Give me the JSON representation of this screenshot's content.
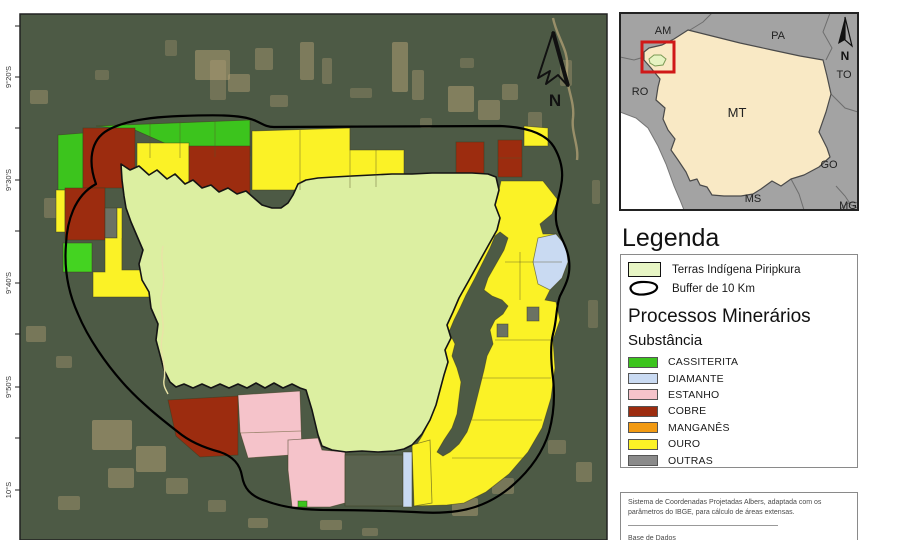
{
  "legend": {
    "title": "Legenda",
    "items": [
      {
        "label": "Terras Indígena Piripkura",
        "swatch_fill": "#e7f5c4"
      },
      {
        "label": "Buffer de 10 Km",
        "swatch": "outline"
      }
    ],
    "section_title": "Processos Minerários",
    "subsection_title": "Substância",
    "substances": [
      {
        "label": "CASSITERITA",
        "color": "#3cc41d"
      },
      {
        "label": "DIAMANTE",
        "color": "#c9daf2"
      },
      {
        "label": "ESTANHO",
        "color": "#f5c3ca"
      },
      {
        "label": "COBRE",
        "color": "#9c2c0f"
      },
      {
        "label": "MANGANÊS",
        "color": "#f29a12"
      },
      {
        "label": "OURO",
        "color": "#fbf226"
      },
      {
        "label": "OUTRAS",
        "color": "#8a8a8a"
      }
    ]
  },
  "notes": {
    "projection": "Sistema de Coordenadas Projetadas Albers, adaptada com os parâmetros do IBGE, para cálculo de áreas extensas.",
    "database_label": "Base de Dados"
  },
  "main_map": {
    "frame": {
      "x": 20,
      "y": 14,
      "w": 587,
      "h": 526
    },
    "bg": "#4d5a45",
    "patch_fill": "#b7a377",
    "patches": [
      [
        195,
        50,
        35,
        30,
        0.5
      ],
      [
        228,
        74,
        22,
        18,
        0.45
      ],
      [
        255,
        48,
        18,
        22,
        0.4
      ],
      [
        300,
        42,
        14,
        38,
        0.45
      ],
      [
        322,
        58,
        10,
        26,
        0.35
      ],
      [
        392,
        42,
        16,
        50,
        0.5
      ],
      [
        412,
        70,
        12,
        30,
        0.4
      ],
      [
        448,
        86,
        26,
        26,
        0.5
      ],
      [
        478,
        100,
        22,
        20,
        0.45
      ],
      [
        502,
        84,
        16,
        16,
        0.4
      ],
      [
        528,
        112,
        14,
        22,
        0.35
      ],
      [
        30,
        90,
        18,
        14,
        0.4
      ],
      [
        44,
        198,
        14,
        20,
        0.35
      ],
      [
        26,
        326,
        20,
        16,
        0.4
      ],
      [
        56,
        356,
        16,
        12,
        0.35
      ],
      [
        92,
        420,
        40,
        30,
        0.55
      ],
      [
        136,
        446,
        30,
        26,
        0.5
      ],
      [
        108,
        468,
        26,
        20,
        0.45
      ],
      [
        166,
        478,
        22,
        16,
        0.4
      ],
      [
        58,
        496,
        22,
        14,
        0.4
      ],
      [
        208,
        500,
        18,
        12,
        0.35
      ],
      [
        248,
        518,
        20,
        10,
        0.4
      ],
      [
        320,
        520,
        22,
        10,
        0.4
      ],
      [
        362,
        528,
        16,
        8,
        0.35
      ],
      [
        452,
        498,
        26,
        18,
        0.45
      ],
      [
        492,
        478,
        22,
        16,
        0.4
      ],
      [
        548,
        440,
        18,
        14,
        0.35
      ],
      [
        576,
        462,
        16,
        20,
        0.4
      ],
      [
        588,
        300,
        10,
        28,
        0.3
      ],
      [
        592,
        180,
        8,
        24,
        0.3
      ],
      [
        262,
        150,
        20,
        12,
        0.3
      ],
      [
        420,
        118,
        12,
        10,
        0.3
      ],
      [
        270,
        95,
        18,
        12,
        0.35
      ],
      [
        350,
        88,
        22,
        10,
        0.3
      ],
      [
        460,
        58,
        14,
        10,
        0.3
      ],
      [
        560,
        60,
        12,
        26,
        0.35
      ],
      [
        240,
        210,
        16,
        9,
        0.3
      ],
      [
        210,
        60,
        16,
        40,
        0.35
      ],
      [
        165,
        40,
        12,
        16,
        0.3
      ],
      [
        95,
        70,
        14,
        10,
        0.3
      ]
    ],
    "rivers_bg": [
      {
        "name": "river-tan",
        "color": "#b3a176",
        "w": 2.4,
        "o": 0.75,
        "d": "M553,18 C557,38 569,50 567,68 C565,86 575,100 573,118 C571,132 579,146 577,160"
      }
    ],
    "features": [
      {
        "name": "claim-cassiterita",
        "fill": "#3cc41d",
        "pts": "96,126 250,120 250,156 198,158 135,130"
      },
      {
        "name": "claim-ouro",
        "fill": "#fbf226",
        "pts": "137,143 189,143 189,198 137,198"
      },
      {
        "name": "claim-cobre",
        "fill": "#9c2c0f",
        "pts": "189,146 250,146 250,198 189,198"
      },
      {
        "name": "claim-cassiterita",
        "fill": "#3cc41d",
        "pts": "58,135 83,133 83,190 58,190"
      },
      {
        "name": "claim-cobre",
        "fill": "#9c2c0f",
        "pts": "83,128 135,128 135,188 83,188"
      },
      {
        "name": "claim-ouro",
        "fill": "#fbf226",
        "pts": "56,190 65,190 65,232 56,232"
      },
      {
        "name": "claim-cobre",
        "fill": "#9c2c0f",
        "pts": "65,188 105,188 105,240 65,240"
      },
      {
        "name": "claim-outras",
        "fill": "#6b7263",
        "pts": "105,208 117,208 117,238 105,238"
      },
      {
        "name": "claim-ouro",
        "fill": "#fbf226",
        "pts": "117,208 122,208 122,270 152,270 152,297 93,297 93,272 105,272 105,238 117,238"
      },
      {
        "name": "claim-cassiterita",
        "fill": "#44d321",
        "pts": "63,243 92,243 92,272 63,272"
      },
      {
        "name": "claim-cassiterita",
        "fill": "#3cc41d",
        "pts": "152,277 190,277 190,307 152,307"
      },
      {
        "name": "claim-ouro",
        "fill": "#fbf226",
        "pts": "252,131 350,128 350,150 404,150 404,187 342,187 342,204 298,204 298,190 252,190"
      },
      {
        "name": "claim-manganes",
        "fill": "#f29a12",
        "pts": "342,187 406,185 406,204 342,204"
      },
      {
        "name": "claim-cobre",
        "fill": "#9c2c0f",
        "pts": "456,142 484,142 484,179 456,179"
      },
      {
        "name": "claim-cobre",
        "fill": "#9c2c0f",
        "pts": "498,140 522,140 522,177 498,177"
      },
      {
        "name": "claim-ouro",
        "fill": "#fbf226",
        "pts": "524,126 548,128 548,146 524,146"
      },
      {
        "name": "claim-ouro",
        "fill": "#fbf226",
        "pts": "501,181 543,181 558,200 552,214 540,224 543,234 556,234 566,246 568,262 562,278 550,290 545,300 556,302 560,320 553,340 555,368 551,398 542,428 528,452 509,474 486,492 464,503 447,505 414,506 412,452 422,436 430,420 436,405 440,390 444,375 448,362 445,350 451,338 447,325 453,312 459,298 468,282 478,264 488,246 497,230 500,218 495,205 499,190"
      },
      {
        "name": "river-corridor",
        "fill": "#4d5a45",
        "pts": "500,232 508,238 504,250 496,264 488,278 484,290 492,296 502,300 508,306 503,314 495,320 490,330 493,344 487,356 484,370 480,386 476,402 472,418 467,432 459,444 450,452 443,456 437,452 444,440 452,428 457,414 459,398 461,382 457,368 452,356 455,344 449,332 454,320 460,308 466,295 474,280 482,264 490,248 495,236"
      },
      {
        "name": "claim-outras",
        "fill": "#6b7263",
        "pts": "527,307 539,307 539,321 527,321"
      },
      {
        "name": "claim-outras",
        "fill": "#6b7263",
        "pts": "497,324 508,324 508,337 497,337"
      },
      {
        "name": "claim-diamante",
        "fill": "#c9daf2",
        "pts": "538,238 556,234 566,246 568,262 562,278 550,290 538,284 533,262"
      },
      {
        "name": "claim-cobre",
        "fill": "#9c2c0f",
        "pts": "168,400 238,396 238,455 200,457 176,436"
      },
      {
        "name": "claim-estanho",
        "fill": "#f5c3ca",
        "pts": "238,395 300,391 302,452 291,455 248,458 240,432"
      },
      {
        "name": "claim-estanho",
        "fill": "#f5c3ca",
        "pts": "288,440 318,438 322,450 345,452 345,503 330,507 292,507 288,470"
      },
      {
        "name": "claim-cassiterita",
        "fill": "#3cc41d",
        "pts": "298,501 307,501 307,507 298,507"
      },
      {
        "name": "claim-outras",
        "fill": "#59624e",
        "pts": "345,455 403,455 403,506 345,506"
      },
      {
        "name": "claim-diamante",
        "fill": "#c9daf2",
        "pts": "403,452 412,452 412,507 403,507"
      },
      {
        "name": "claim-ouro",
        "fill": "#fbf226",
        "pts": "412,445 430,440 432,503 414,506"
      }
    ],
    "territory": {
      "fill": "#dcefa1",
      "stroke": "#141414",
      "pts": "121,164 130,170 139,166 149,175 157,170 167,179 175,174 185,184 193,180 202,188 211,185 219,192 228,188 237,194 246,191 254,198 262,205 272,208 281,208 288,203 293,195 298,184 306,180 318,178 334,177 352,176 372,175 392,174 412,174 432,173 452,173 472,173 488,174 496,177 499,190 495,205 500,218 497,230 488,246 478,264 468,282 459,298 453,312 447,325 451,338 445,350 448,362 444,375 440,390 436,405 430,420 422,434 412,445 404,449 394,451 378,452 362,451 346,452 332,450 322,446 318,435 312,410 306,390 300,388 292,384 283,388 274,383 265,388 256,383 247,388 238,384 229,388 220,384 211,388 202,384 193,388 184,384 176,387 170,382 164,370 160,355 156,340 158,324 151,308 149,292 142,280 139,264 143,250 137,236 131,222 126,208 124,196 122,180"
    },
    "stream": {
      "color": "#e9e3a6",
      "w": 1.4,
      "d": "M163,246 C159,262 167,276 162,292 C158,308 166,322 162,338 C159,354 167,366 164,380 C163,386 166,390 168,394"
    },
    "dividers": [
      "150,122 150,158",
      "180,121 180,158",
      "215,121 215,157",
      "300,130 300,190",
      "350,128 350,188",
      "376,150 376,187",
      "498,158 522,158",
      "520,252 520,300",
      "505,262 562,262",
      "495,340 553,340",
      "480,378 551,378",
      "472,420 542,420",
      "452,458 528,458",
      "240,433 301,431",
      "122,238 122,270"
    ],
    "buffer": {
      "stroke": "#000000",
      "w": 2.2,
      "d": "M96,184 C88,162 90,140 108,130 C124,121 150,117 180,116 C210,115 242,114 256,121 C263,124 266,127 274,127 L500,126 C524,127 545,132 554,147 C561,159 564,172 561,186 C559,198 555,206 556,220 C557,234 567,244 569,260 C571,276 565,286 560,296 C556,306 557,320 553,334 C550,346 551,362 553,378 C555,396 554,414 549,432 C543,452 530,470 513,485 C497,499 478,508 458,511 C445,513 428,513 414,512 C390,511 360,510 330,510 C305,510 285,508 266,501 C250,496 244,488 242,476 C240,464 232,456 220,452 C205,448 190,442 178,432 C160,418 140,402 124,384 C106,364 88,338 78,314 C68,292 64,268 66,244 C67,222 74,196 96,184 Z"
    },
    "graticule": {
      "tick_ys": [
        26,
        77,
        128,
        180,
        231,
        283,
        334,
        387,
        438,
        490
      ],
      "labels": [
        {
          "y": 77,
          "text": "9°20'S"
        },
        {
          "y": 180,
          "text": "9°30'S"
        },
        {
          "y": 283,
          "text": "9°40'S"
        },
        {
          "y": 387,
          "text": "9°50'S"
        },
        {
          "y": 490,
          "text": "10°S"
        }
      ]
    },
    "north": {
      "label": "N",
      "outline": "M553,32 L538,78 L550,71 L546,84 L558,75 L568,86 Z",
      "thick": "M553,32 L568,86",
      "label_x": 555,
      "label_y": 106
    }
  },
  "inset": {
    "frame": {
      "x": 620,
      "y": 13,
      "w": 238,
      "h": 197
    },
    "bg": "#a3a3a3",
    "white_area": "620,112 636,118 648,128 658,146 666,164 674,186 680,200 684,210 620,210",
    "mt": {
      "fill": "#f9e9c5",
      "stroke": "#4a4a4a",
      "pts": "688,30 712,36 740,43 772,50 800,56 823,60 827,76 831,94 826,112 819,132 827,148 830,157 819,167 804,175 791,179 781,186 772,181 761,189 753,194 741,196 724,196 712,195 707,187 700,185 697,179 690,181 686,172 678,160 671,150 675,139 668,130 663,119 665,108 656,100 658,87 660,79 651,68 644,60 644,52 649,48 662,45 674,39"
    },
    "borders": [
      "M712,13 L703,22 L690,30",
      "M830,13 L823,32 L832,48 L826,60",
      "M831,94 L845,108 L858,112",
      "M836,186 L845,196 L851,205 L858,208",
      "M791,179 L799,194 L804,210",
      "M620,57 L634,60 L644,57",
      "M840,210 Q848,200 858,203"
    ],
    "highlight": {
      "x": 642,
      "y": 42,
      "w": 32,
      "h": 30,
      "color": "#d01818"
    },
    "territory_mini": {
      "fill": "#e6f3c2",
      "stroke": "#7a9a55",
      "pts": "649,59 654,55 661,55 666,59 663,65 655,66 650,63"
    },
    "labels": [
      {
        "text": "AM",
        "x": 663,
        "y": 34
      },
      {
        "text": "PA",
        "x": 778,
        "y": 39
      },
      {
        "text": "RO",
        "x": 640,
        "y": 95
      },
      {
        "text": "MT",
        "x": 737,
        "y": 117
      },
      {
        "text": "TO",
        "x": 844,
        "y": 78
      },
      {
        "text": "GO",
        "x": 829,
        "y": 168
      },
      {
        "text": "MS",
        "x": 753,
        "y": 202
      },
      {
        "text": "MG",
        "x": 848,
        "y": 209
      }
    ],
    "north": {
      "label": "N",
      "tri_fill": "845,17 838,44 845,40",
      "tri_out": "845,17 852,46 845,40",
      "label_x": 845,
      "label_y": 60
    }
  }
}
